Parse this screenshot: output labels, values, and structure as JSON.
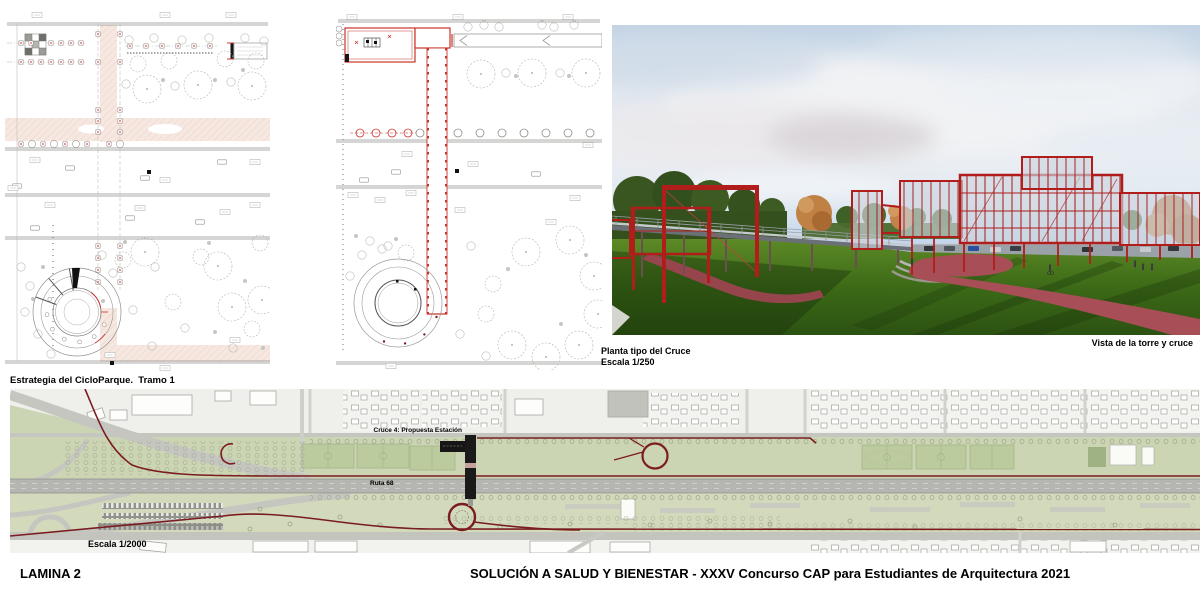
{
  "board": {
    "sheet_label": "LAMINA 2",
    "footer_title": "SOLUCIÓN A SALUD Y BIENESTAR - XXXV Concurso CAP para Estudiantes de Arquitectura 2021"
  },
  "plan_tramo": {
    "caption": "Estrategia del CicloParque.  Tramo 1"
  },
  "plan_cruce": {
    "caption_title": "Planta tipo del Cruce",
    "caption_scale": "Escala 1/250"
  },
  "render_view": {
    "caption": "Vista de la torre y cruce"
  },
  "site_map": {
    "label_station": "Cruce 4: Propuesta Estación",
    "label_route": "Ruta 68",
    "label_scale": "Escala 1/2000"
  },
  "colors": {
    "cycle_route": "#7a1c20",
    "plan_accent_red": "#c9342c",
    "plan_pink_band": "#f6e8e1",
    "map_green": "#ccd5b3",
    "map_field_green": "#bccb9e",
    "map_road_gray": "#b5b5b1",
    "render_structure_red": "#b01d1a",
    "render_path_pink": "#a84e56",
    "render_grass_green": "#3c6a17",
    "render_sky_blue": "#a9c8e8"
  }
}
